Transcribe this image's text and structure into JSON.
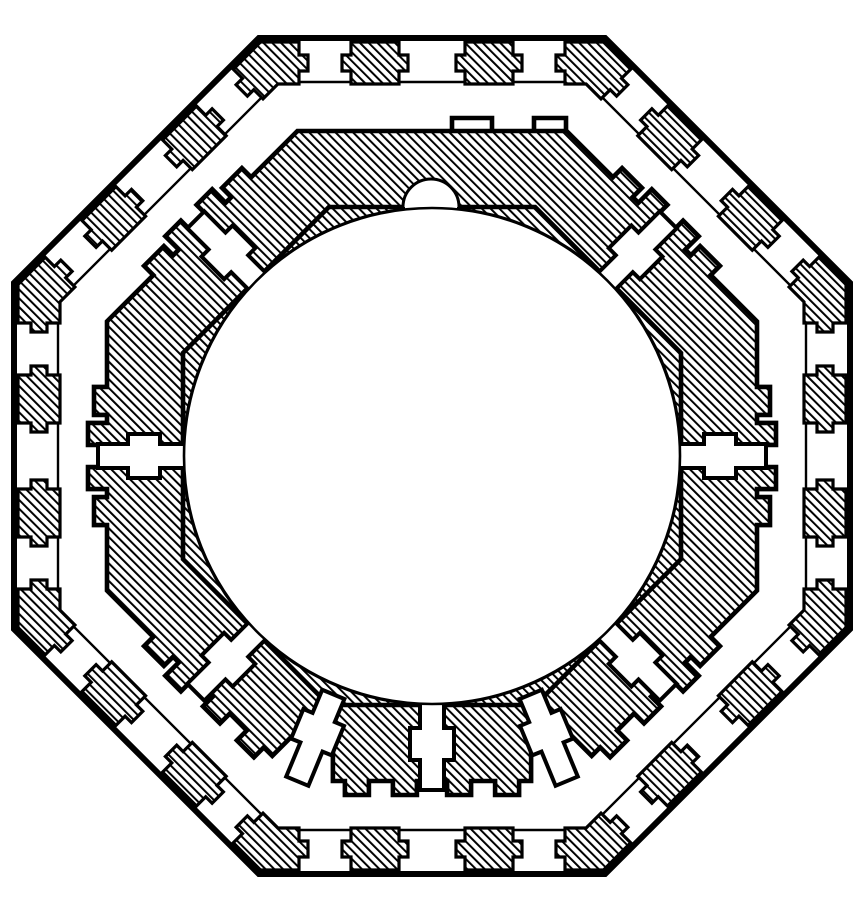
{
  "figure": {
    "title": "Engraved plan of an octagonal masonry tower with eight castellated piers around a central circular opening and a semicircular niche at top",
    "canvas": {
      "width": 865,
      "height": 899
    },
    "colors": {
      "ink": "#000000",
      "paper": "#ffffff"
    },
    "hatch": {
      "spacing": 6.2,
      "line_width": 2.0,
      "angle_deg": -45
    },
    "center": {
      "x": 432,
      "y": 456
    },
    "outer_wall": {
      "outer_apothem": 418,
      "inner_apothem": 374,
      "outline_stroke": 6,
      "inner_line_stroke": 2.4,
      "block_stroke": 3.2,
      "block_front": 4,
      "block_back": 46,
      "jamb_tab": {
        "from": 17,
        "to": 33,
        "depth": 9
      },
      "block_centers": [
        -57,
        57
      ],
      "block_half_width": 24,
      "corner_piece_from": 133,
      "side_normals_deg": [
        90,
        45,
        0,
        315,
        270,
        225,
        180,
        135
      ]
    },
    "pier_ring": {
      "chord_radius": 249,
      "slab_height": 76,
      "merlon_height": 89,
      "end_tab_height": 95,
      "bump_height": 90,
      "pier_stroke": 4.6,
      "wedge_stroke": 2,
      "end_offset": 96,
      "bent_half_slab": {
        "merlon": [
          34,
          62
        ],
        "end_tab": [
          70,
          92
        ]
      },
      "single_slab": {
        "near": 4,
        "far": 96,
        "bumps": [
          [
            16,
            40
          ],
          [
            64,
            88
          ]
        ]
      },
      "top_merlons": [
        [
          20,
          60
        ],
        [
          102,
          134
        ]
      ],
      "bent_vertices_deg": [
        22.5,
        157.5,
        202.5,
        337.5
      ],
      "single_slabs": [
        {
          "chord_deg": 270,
          "vertex_deg": 247.5
        },
        {
          "chord_deg": 270,
          "vertex_deg": 292.5
        },
        {
          "chord_deg": 225,
          "vertex_deg": 247.5
        },
        {
          "chord_deg": 315,
          "vertex_deg": 292.5
        }
      ],
      "top_pier": {
        "right_chord_deg": 45,
        "mid_chord_deg": 90,
        "left_chord_deg": 135
      },
      "wedge_vertices_deg": [
        22.5,
        67.5,
        112.5,
        157.5,
        202.5,
        247.5,
        292.5,
        337.5
      ]
    },
    "joints": {
      "stroke": 4,
      "tangent_joints_deg": [
        0,
        45,
        135,
        180,
        225,
        270,
        315
      ],
      "tangent_profile": {
        "u": [
          244,
          272,
          304,
          334
        ],
        "w_narrow": 12,
        "w_wide": 22
      },
      "vertex_joints_deg": [
        247.5,
        292.5
      ],
      "vertex_profile": {
        "u": [
          258,
          283,
          315,
          352
        ],
        "w_narrow": 12,
        "w_wide": 22
      }
    },
    "central_circle": {
      "radius": 248,
      "stroke": 2.6
    },
    "niche": {
      "cx": 431,
      "chord_y_radius": 249,
      "radius": 28,
      "stroke": 3
    }
  }
}
